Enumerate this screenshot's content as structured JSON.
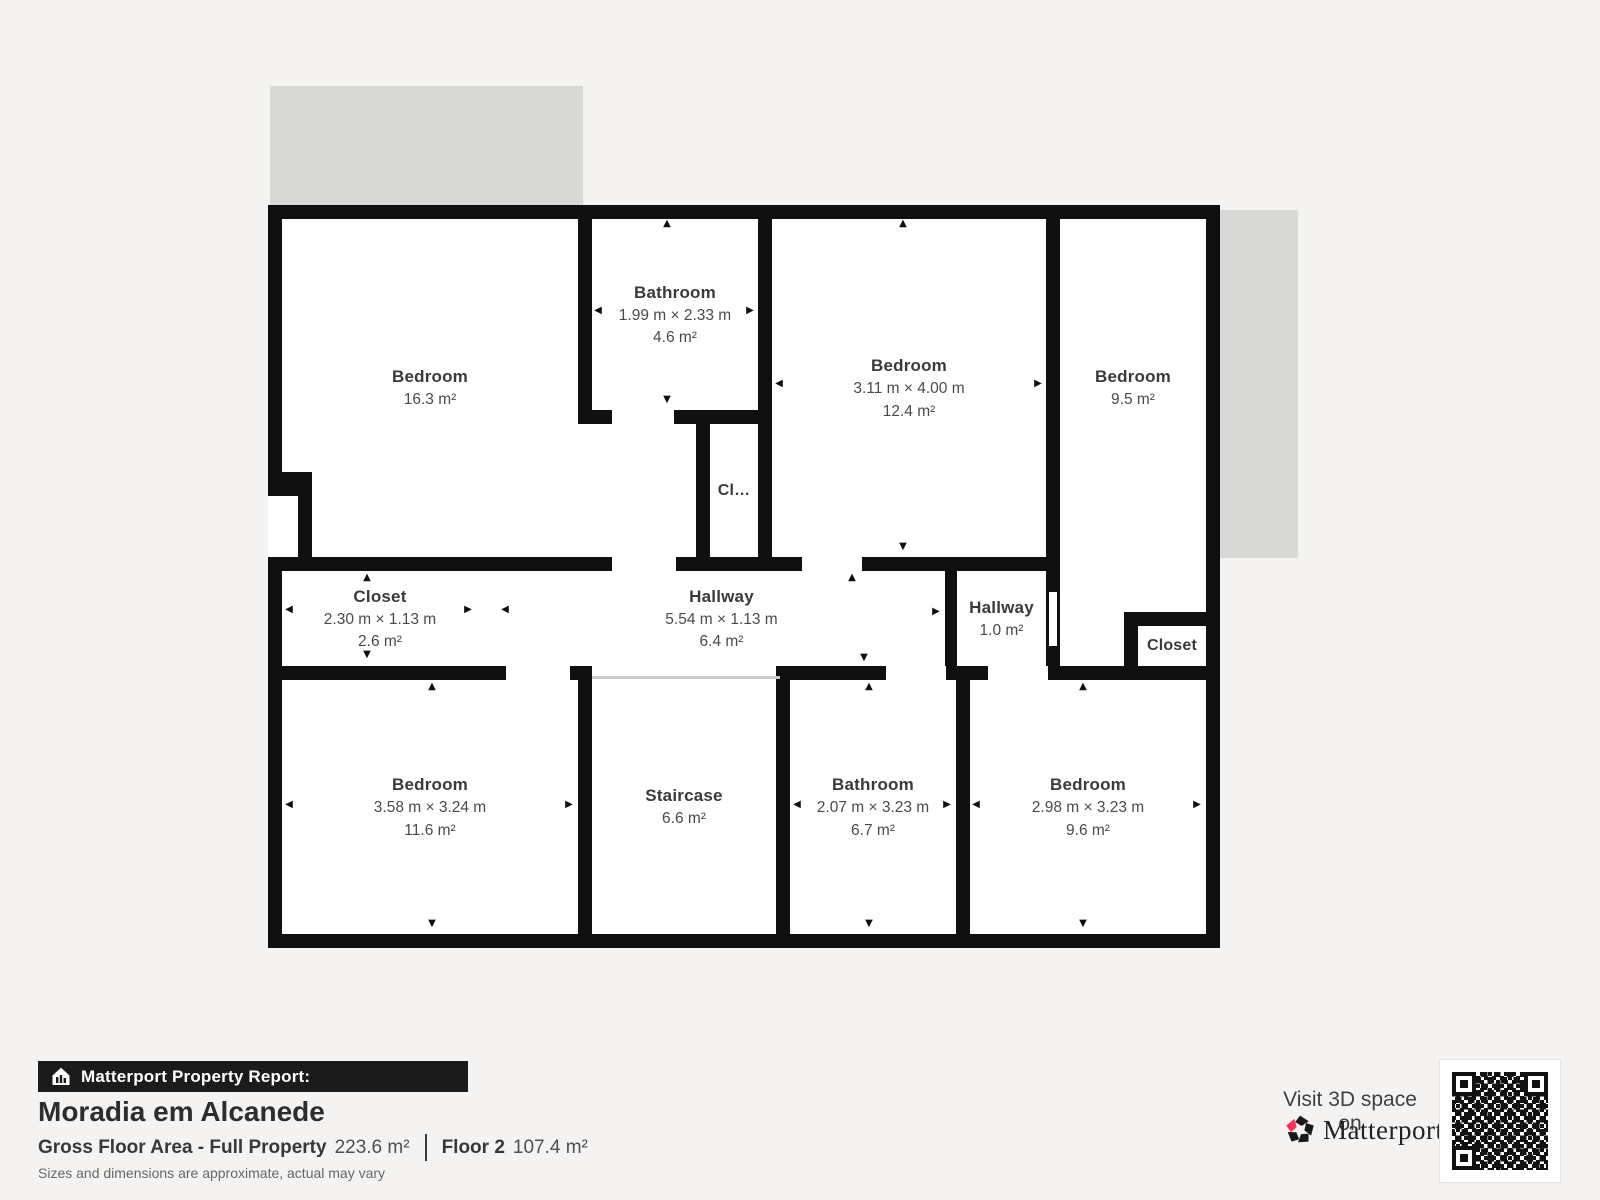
{
  "plan": {
    "rooms": {
      "bedroom_tl": {
        "name": "Bedroom",
        "area": "16.3 m²"
      },
      "bathroom_top": {
        "name": "Bathroom",
        "dims": "1.99 m × 2.33 m",
        "area": "4.6 m²"
      },
      "closet_mid": {
        "name": "Cl…"
      },
      "bedroom_mid": {
        "name": "Bedroom",
        "dims": "3.11 m × 4.00 m",
        "area": "12.4 m²"
      },
      "bedroom_right": {
        "name": "Bedroom",
        "area": "9.5 m²"
      },
      "closet_left": {
        "name": "Closet",
        "dims": "2.30 m × 1.13 m",
        "area": "2.6 m²"
      },
      "hallway_main": {
        "name": "Hallway",
        "dims": "5.54 m × 1.13 m",
        "area": "6.4 m²"
      },
      "hallway_small": {
        "name": "Hallway",
        "area": "1.0 m²"
      },
      "closet_right": {
        "name": "Closet"
      },
      "bedroom_bl": {
        "name": "Bedroom",
        "dims": "3.58 m × 3.24 m",
        "area": "11.6 m²"
      },
      "staircase": {
        "name": "Staircase",
        "area": "6.6 m²"
      },
      "bathroom_bottom": {
        "name": "Bathroom",
        "dims": "2.07 m × 3.23 m",
        "area": "6.7 m²"
      },
      "bedroom_br": {
        "name": "Bedroom",
        "dims": "2.98 m × 3.23 m",
        "area": "9.6 m²"
      }
    }
  },
  "report": {
    "badge": "Matterport Property Report:",
    "title": "Moradia em Alcanede",
    "metrics": [
      {
        "label": "Gross Floor Area - Full Property",
        "value": "223.6 m²"
      },
      {
        "label": "Floor 2",
        "value": "107.4 m²"
      }
    ],
    "disclaimer": "Sizes and dimensions are approximate, actual may vary"
  },
  "cta": {
    "line": "Visit 3D space on",
    "brand": "Matterport",
    "brand_mark": "’"
  },
  "colors": {
    "wall": "#0f0f0f",
    "terrace": "#d8d8d7",
    "page_bg": "#f4f3f1",
    "accent_red": "#ff3158",
    "qr_ink": "#111111"
  },
  "icons": {
    "badge": "house-bars-icon",
    "brand": "matterport-pinwheel-icon",
    "qr": "qr-code"
  }
}
